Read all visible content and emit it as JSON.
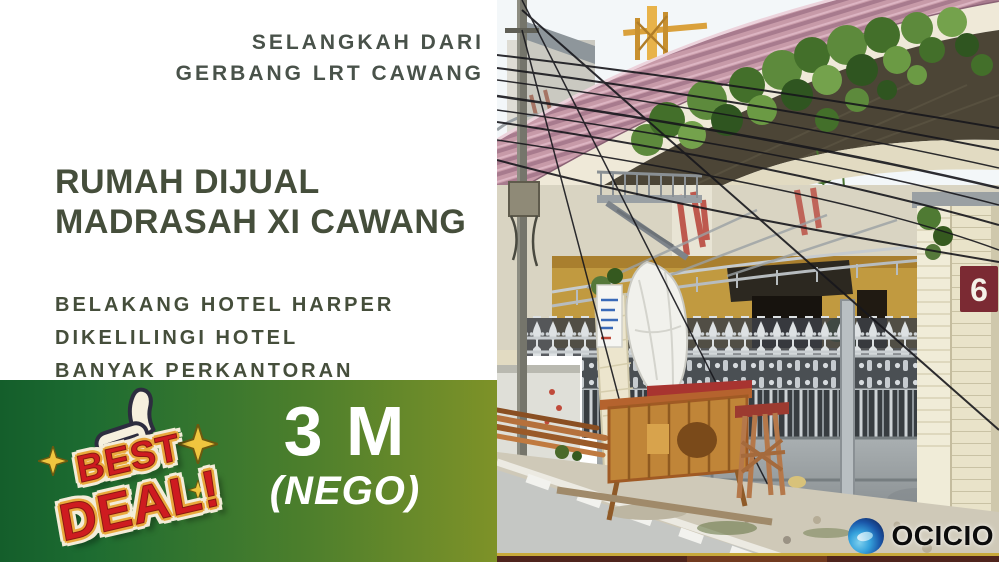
{
  "left_panel": {
    "tagline": [
      "SELANGKAH DARI",
      "GERBANG LRT CAWANG"
    ],
    "title": [
      "RUMAH DIJUAL",
      "MADRASAH XI CAWANG"
    ],
    "features": [
      "BELAKANG HOTEL HARPER",
      "DIKELILINGI HOTEL",
      "BANYAK PERKANTORAN"
    ],
    "price": {
      "amount": "3 M",
      "note": "(NEGO)"
    },
    "badge": {
      "line1": "BEST",
      "line2": "DEAL!"
    }
  },
  "photo": {
    "house_number": "6",
    "watermark": "OCICIO",
    "alt": "Street photo of a two-storey house with a pink corrugated roof, plants overgrowing the upper balcony, an ornate silver gate with spiked fence, a wooden cart and stacked planks beside a road with white dashed markings, and a utility pole with tangled cables"
  },
  "colors": {
    "text_dark_olive": "#454e3b",
    "gradient_left": "#145e2b",
    "gradient_right": "#7e9228",
    "price_text": "#ffffff",
    "badge_red": "#ce1b20",
    "badge_gold": "#e9a93c",
    "badge_cream": "#f3ecd9",
    "roof_pink": "#c596a6",
    "wall_mustard": "#c19a40",
    "house_number_plate": "#7b2a33",
    "logo_blue": "#2f86c8"
  }
}
